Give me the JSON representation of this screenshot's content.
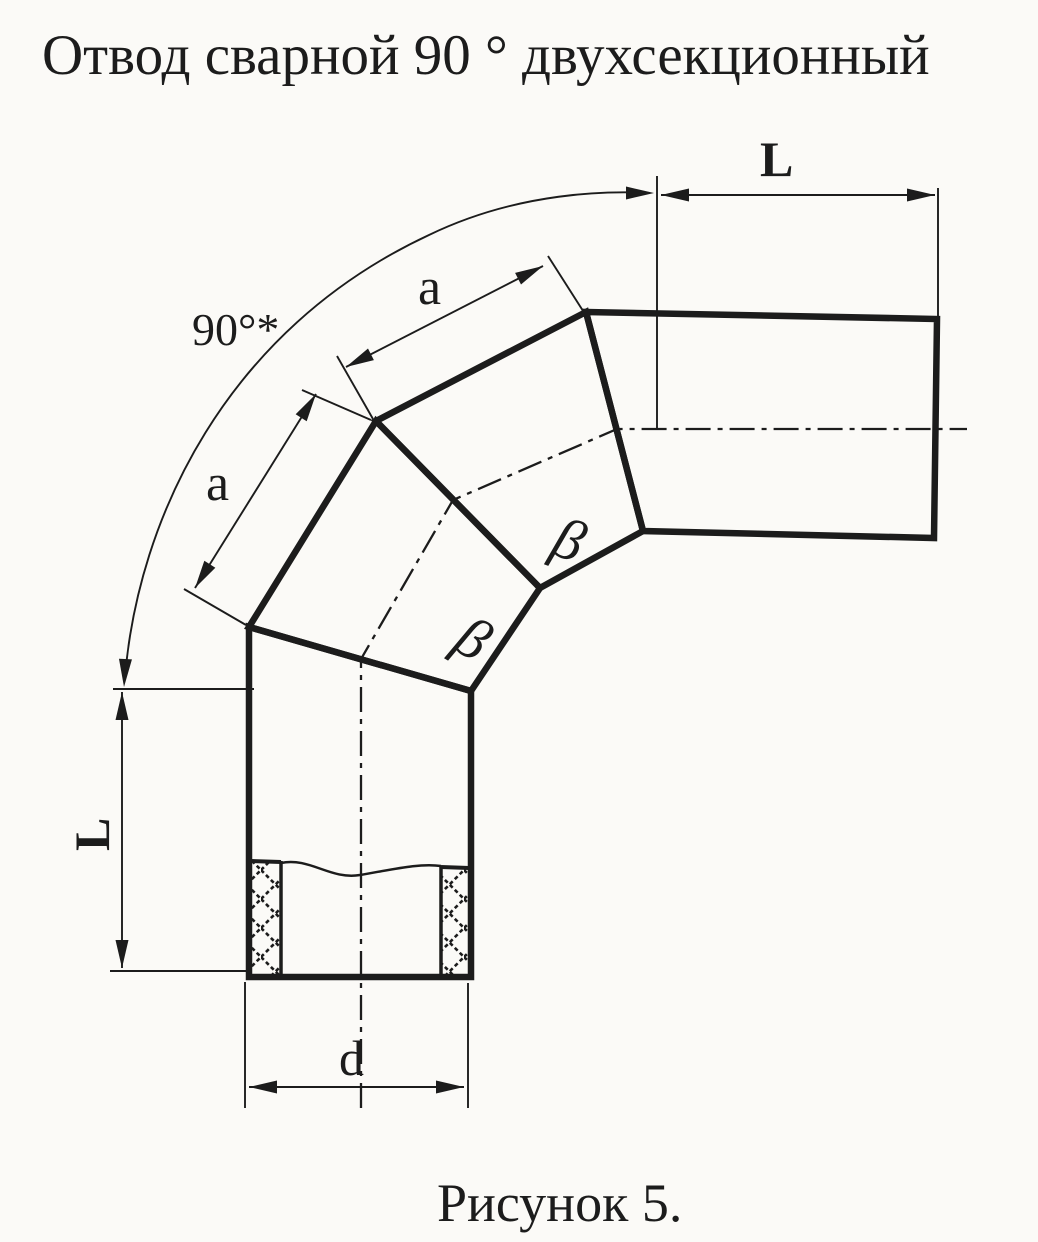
{
  "page": {
    "title": "Отвод сварной 90 ° двухсекционный",
    "caption": "Рисунок 5."
  },
  "drawing": {
    "description": "Side view of a welded 90-degree two-section pipe elbow with weld seams, centerlines, cross-hatched wall section and dimension callouts",
    "dimension_labels": {
      "angle": "90°*",
      "top_run_length": "L",
      "left_run_length": "L",
      "segment_outer_upper": "a",
      "segment_outer_lower": "a",
      "pipe_diameter": "d"
    },
    "section_markers": [
      "β",
      "β"
    ],
    "colors": {
      "ink": "#1c1c1c",
      "paper": "#fbfaf7"
    }
  }
}
